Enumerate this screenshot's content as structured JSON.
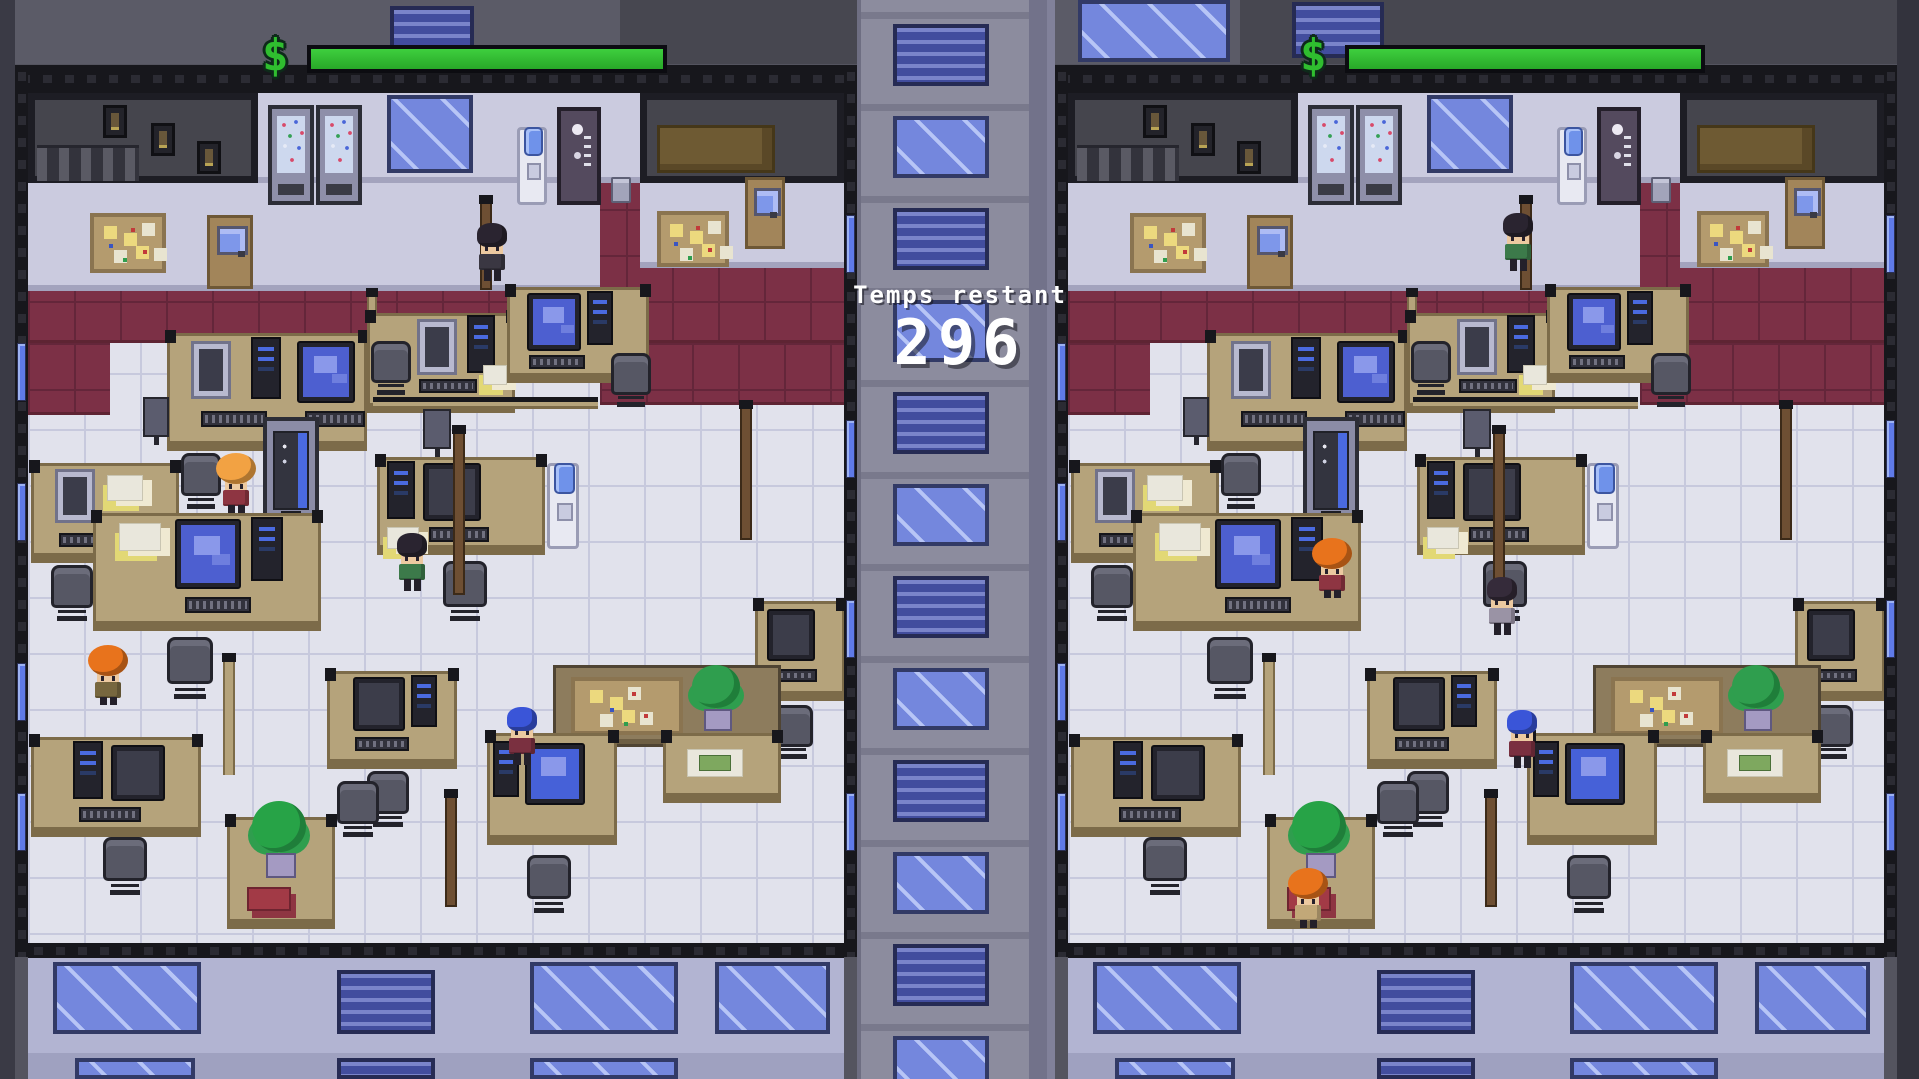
{
  "hud": {
    "symbol": "$",
    "bar_color_top": "#3ecf3e",
    "bar_color_bottom": "#28a828",
    "bars": [
      {
        "side": "left",
        "fill": 1.0
      },
      {
        "side": "right",
        "fill": 1.0
      }
    ]
  },
  "timer": {
    "label": "Temps restant",
    "value": "296"
  },
  "scene": {
    "names": {
      "tile": "tile-floor",
      "carpet": "carpet-floor",
      "darkroom": "dark-room",
      "lavwall": "wall",
      "shelf": "storage-shelf",
      "stairs": "stairs",
      "frame": "picture-frame",
      "winbig": "window",
      "winblinds": "blinds-window",
      "winstrip": "wall-window",
      "vendflower": "flower-vending-machine",
      "venddrink": "vending-machine",
      "coffee": "coffee-machine",
      "cooler": "water-cooler",
      "trash": "trash-bin",
      "board": "cork-board",
      "door": "door",
      "desk": "desk",
      "partition": "cubicle-partition",
      "railh": "cubicle-rail",
      "railv": "cubicle-rail",
      "pole": "cubicle-post",
      "crt": "computer-crt",
      "monitor": "computer-monitor",
      "monitord": "computer-monitor",
      "monitorB": "computer-monitor",
      "tower": "computer-tower",
      "keyboard": "keyboard",
      "chair": "office-chair",
      "camera": "desk-monitor",
      "plant": "potted-plant",
      "palm": "potted-palm",
      "money": "desk-papers",
      "papers": "desk-papers",
      "redbook": "red-binder",
      "extwall": "exterior-wall",
      "extwall2": "exterior-wall",
      "girderh": "steel-beam",
      "girderv": "steel-beam",
      "bgrect": "background-wall"
    },
    "backdrop": [
      {
        "t": "bgrect",
        "x": 0,
        "y": 0,
        "w": 860,
        "h": 64,
        "c": "#5b5b67"
      },
      {
        "t": "bgrect",
        "x": 620,
        "y": 0,
        "w": 240,
        "h": 64,
        "c": "#474750"
      },
      {
        "t": "winblinds",
        "x": 390,
        "y": 6,
        "w": 84,
        "h": 52
      },
      {
        "t": "bgrect",
        "x": 1055,
        "y": 0,
        "w": 842,
        "h": 64,
        "c": "#5b5b67"
      },
      {
        "t": "winbig",
        "x": 1078,
        "y": 0,
        "w": 152,
        "h": 62
      },
      {
        "t": "bgrect",
        "x": 1240,
        "y": 0,
        "w": 657,
        "h": 64,
        "c": "#474750"
      },
      {
        "t": "winblinds",
        "x": 1292,
        "y": 2,
        "w": 92,
        "h": 56
      },
      {
        "t": "bgrect",
        "x": 0,
        "y": 0,
        "w": 15,
        "h": 1079,
        "c": "#3a3a45"
      },
      {
        "t": "bgrect",
        "x": 1897,
        "y": 0,
        "w": 22,
        "h": 1079,
        "c": "#33333d"
      }
    ],
    "divider": {
      "x": 857,
      "y": 0,
      "w": 198,
      "h": 1079,
      "base": "#8c8c9e",
      "ledge": "#79798c",
      "seams": [
        {
          "x": 0,
          "w": 4,
          "c": "#6e6e82"
        },
        {
          "x": 172,
          "w": 18,
          "c": "#72728a"
        },
        {
          "x": 190,
          "w": 8,
          "c": "#81819a"
        }
      ],
      "windows": {
        "x": 36,
        "w": 96,
        "h": 62,
        "start": 24,
        "step": 92,
        "count": 12
      }
    },
    "panels": [
      {
        "id": "left",
        "name": "office-left",
        "x": 15,
        "y": 65
      },
      {
        "id": "right",
        "name": "office-right",
        "x": 1055,
        "y": 65
      }
    ],
    "furniture": [
      {
        "t": "tile",
        "x": 13,
        "y": 28,
        "w": 816,
        "h": 850
      },
      {
        "t": "carpet",
        "x": 13,
        "y": 98,
        "w": 816,
        "h": 180
      },
      {
        "t": "carpet",
        "x": 13,
        "y": 278,
        "w": 82,
        "h": 72
      },
      {
        "t": "carpet",
        "x": 585,
        "y": 278,
        "w": 244,
        "h": 62
      },
      {
        "t": "darkroom",
        "x": 13,
        "y": 28,
        "w": 230,
        "h": 90
      },
      {
        "t": "frame",
        "x": 88,
        "y": 40,
        "w": 24,
        "h": 33
      },
      {
        "t": "frame",
        "x": 136,
        "y": 58,
        "w": 24,
        "h": 33
      },
      {
        "t": "frame",
        "x": 182,
        "y": 76,
        "w": 24,
        "h": 33
      },
      {
        "t": "stairs",
        "x": 22,
        "y": 80,
        "w": 102,
        "h": 36
      },
      {
        "t": "lavwall",
        "x": 243,
        "y": 28,
        "w": 382,
        "h": 90
      },
      {
        "t": "darkroom",
        "x": 625,
        "y": 28,
        "w": 204,
        "h": 90
      },
      {
        "t": "shelf",
        "x": 642,
        "y": 60,
        "w": 118,
        "h": 48
      },
      {
        "t": "lavwall",
        "x": 13,
        "y": 118,
        "w": 572,
        "h": 108
      },
      {
        "t": "lavwall",
        "x": 625,
        "y": 118,
        "w": 204,
        "h": 85
      },
      {
        "t": "vendflower",
        "x": 253,
        "y": 40,
        "w": 46,
        "h": 100,
        "i": 1
      },
      {
        "t": "vendflower",
        "x": 301,
        "y": 40,
        "w": 46,
        "h": 100,
        "i": 1
      },
      {
        "t": "winbig",
        "x": 372,
        "y": 30,
        "w": 86,
        "h": 78
      },
      {
        "t": "cooler",
        "x": 502,
        "y": 62,
        "w": 30,
        "h": 78,
        "i": 1
      },
      {
        "t": "coffee",
        "x": 542,
        "y": 42,
        "w": 44,
        "h": 98,
        "i": 1
      },
      {
        "t": "trash",
        "x": 596,
        "y": 112,
        "w": 20,
        "h": 26
      },
      {
        "t": "board",
        "x": 75,
        "y": 148,
        "w": 76,
        "h": 60
      },
      {
        "t": "door",
        "x": 192,
        "y": 150,
        "w": 46,
        "h": 74,
        "i": 1
      },
      {
        "t": "board",
        "x": 642,
        "y": 146,
        "w": 72,
        "h": 56
      },
      {
        "t": "door",
        "x": 730,
        "y": 112,
        "w": 40,
        "h": 72,
        "i": 1
      },
      {
        "t": "pole",
        "x": 465,
        "y": 130,
        "w": 12,
        "h": 95
      },
      {
        "t": "railv",
        "x": 352,
        "y": 225,
        "w": 10,
        "h": 120
      },
      {
        "t": "desk",
        "x": 152,
        "y": 268,
        "w": 200,
        "h": 118
      },
      {
        "t": "crt",
        "x": 176,
        "y": 276,
        "w": 40,
        "h": 58
      },
      {
        "t": "tower",
        "x": 236,
        "y": 272,
        "w": 30,
        "h": 62
      },
      {
        "t": "monitor",
        "x": 282,
        "y": 276,
        "w": 58,
        "h": 62
      },
      {
        "t": "keyboard",
        "x": 186,
        "y": 346,
        "w": 66,
        "h": 16
      },
      {
        "t": "keyboard",
        "x": 290,
        "y": 346,
        "w": 60,
        "h": 16
      },
      {
        "t": "chair",
        "x": 166,
        "y": 388,
        "w": 40,
        "h": 58
      },
      {
        "t": "camera",
        "x": 128,
        "y": 332,
        "w": 26,
        "h": 40
      },
      {
        "t": "desk",
        "x": 352,
        "y": 248,
        "w": 148,
        "h": 100
      },
      {
        "t": "crt",
        "x": 402,
        "y": 254,
        "w": 40,
        "h": 56
      },
      {
        "t": "tower",
        "x": 452,
        "y": 250,
        "w": 28,
        "h": 58
      },
      {
        "t": "keyboard",
        "x": 404,
        "y": 314,
        "w": 58,
        "h": 14
      },
      {
        "t": "papers",
        "x": 468,
        "y": 300,
        "w": 24,
        "h": 20
      },
      {
        "t": "chair",
        "x": 356,
        "y": 276,
        "w": 40,
        "h": 56
      },
      {
        "t": "desk",
        "x": 492,
        "y": 222,
        "w": 142,
        "h": 96
      },
      {
        "t": "monitor",
        "x": 512,
        "y": 228,
        "w": 54,
        "h": 58
      },
      {
        "t": "tower",
        "x": 572,
        "y": 226,
        "w": 26,
        "h": 54
      },
      {
        "t": "keyboard",
        "x": 514,
        "y": 290,
        "w": 56,
        "h": 14
      },
      {
        "t": "chair",
        "x": 596,
        "y": 288,
        "w": 40,
        "h": 56
      },
      {
        "t": "desk",
        "x": 16,
        "y": 398,
        "w": 148,
        "h": 100
      },
      {
        "t": "crt",
        "x": 40,
        "y": 404,
        "w": 40,
        "h": 54
      },
      {
        "t": "papers",
        "x": 92,
        "y": 410,
        "w": 36,
        "h": 26
      },
      {
        "t": "keyboard",
        "x": 44,
        "y": 468,
        "w": 58,
        "h": 14
      },
      {
        "t": "chair",
        "x": 36,
        "y": 500,
        "w": 42,
        "h": 58
      },
      {
        "t": "venddrink",
        "x": 248,
        "y": 352,
        "w": 56,
        "h": 112,
        "i": 1
      },
      {
        "t": "railh",
        "x": 358,
        "y": 332,
        "w": 225,
        "h": 12
      },
      {
        "t": "camera",
        "x": 408,
        "y": 344,
        "w": 28,
        "h": 40
      },
      {
        "t": "desk",
        "x": 362,
        "y": 392,
        "w": 168,
        "h": 98
      },
      {
        "t": "tower",
        "x": 372,
        "y": 396,
        "w": 28,
        "h": 58
      },
      {
        "t": "monitord",
        "x": 408,
        "y": 398,
        "w": 58,
        "h": 58
      },
      {
        "t": "papers",
        "x": 372,
        "y": 462,
        "w": 32,
        "h": 22
      },
      {
        "t": "keyboard",
        "x": 414,
        "y": 462,
        "w": 60,
        "h": 15
      },
      {
        "t": "cooler",
        "x": 532,
        "y": 398,
        "w": 32,
        "h": 86,
        "i": 1
      },
      {
        "t": "chair",
        "x": 428,
        "y": 496,
        "w": 44,
        "h": 62
      },
      {
        "t": "desk",
        "x": 78,
        "y": 448,
        "w": 228,
        "h": 118
      },
      {
        "t": "papers",
        "x": 104,
        "y": 458,
        "w": 42,
        "h": 28
      },
      {
        "t": "monitor",
        "x": 160,
        "y": 454,
        "w": 66,
        "h": 70
      },
      {
        "t": "tower",
        "x": 236,
        "y": 452,
        "w": 32,
        "h": 64
      },
      {
        "t": "keyboard",
        "x": 170,
        "y": 532,
        "w": 66,
        "h": 16
      },
      {
        "t": "chair",
        "x": 152,
        "y": 572,
        "w": 46,
        "h": 64
      },
      {
        "t": "pole",
        "x": 438,
        "y": 360,
        "w": 12,
        "h": 170
      },
      {
        "t": "pole",
        "x": 725,
        "y": 335,
        "w": 12,
        "h": 140
      },
      {
        "t": "desk",
        "x": 740,
        "y": 536,
        "w": 90,
        "h": 100
      },
      {
        "t": "monitord",
        "x": 752,
        "y": 544,
        "w": 48,
        "h": 52
      },
      {
        "t": "keyboard",
        "x": 754,
        "y": 604,
        "w": 48,
        "h": 13
      },
      {
        "t": "chair",
        "x": 756,
        "y": 640,
        "w": 42,
        "h": 56
      },
      {
        "t": "desk",
        "x": 312,
        "y": 606,
        "w": 130,
        "h": 98
      },
      {
        "t": "monitord",
        "x": 338,
        "y": 612,
        "w": 52,
        "h": 54
      },
      {
        "t": "tower",
        "x": 396,
        "y": 610,
        "w": 26,
        "h": 52
      },
      {
        "t": "keyboard",
        "x": 340,
        "y": 672,
        "w": 54,
        "h": 14
      },
      {
        "t": "chair",
        "x": 352,
        "y": 706,
        "w": 42,
        "h": 58
      },
      {
        "t": "partition",
        "x": 538,
        "y": 600,
        "w": 228,
        "h": 82
      },
      {
        "t": "board",
        "x": 556,
        "y": 612,
        "w": 112,
        "h": 58
      },
      {
        "t": "plant",
        "x": 672,
        "y": 600,
        "w": 58,
        "h": 70
      },
      {
        "t": "desk",
        "x": 648,
        "y": 668,
        "w": 118,
        "h": 70
      },
      {
        "t": "money",
        "x": 672,
        "y": 684,
        "w": 56,
        "h": 28
      },
      {
        "t": "desk",
        "x": 16,
        "y": 672,
        "w": 170,
        "h": 100
      },
      {
        "t": "tower",
        "x": 58,
        "y": 676,
        "w": 30,
        "h": 58
      },
      {
        "t": "monitord",
        "x": 96,
        "y": 680,
        "w": 54,
        "h": 56
      },
      {
        "t": "keyboard",
        "x": 64,
        "y": 742,
        "w": 62,
        "h": 15
      },
      {
        "t": "chair",
        "x": 88,
        "y": 772,
        "w": 44,
        "h": 60
      },
      {
        "t": "railv",
        "x": 208,
        "y": 590,
        "w": 12,
        "h": 120
      },
      {
        "t": "desk",
        "x": 212,
        "y": 752,
        "w": 108,
        "h": 112
      },
      {
        "t": "palm",
        "x": 232,
        "y": 736,
        "w": 64,
        "h": 82
      },
      {
        "t": "redbook",
        "x": 232,
        "y": 822,
        "w": 44,
        "h": 24
      },
      {
        "t": "chair",
        "x": 322,
        "y": 716,
        "w": 42,
        "h": 58
      },
      {
        "t": "pole",
        "x": 430,
        "y": 724,
        "w": 12,
        "h": 118
      },
      {
        "t": "desk",
        "x": 472,
        "y": 668,
        "w": 130,
        "h": 112
      },
      {
        "t": "tower",
        "x": 478,
        "y": 676,
        "w": 26,
        "h": 56
      },
      {
        "t": "monitorB",
        "x": 510,
        "y": 678,
        "w": 60,
        "h": 62
      },
      {
        "t": "chair",
        "x": 512,
        "y": 790,
        "w": 44,
        "h": 60
      },
      {
        "t": "extwall",
        "x": 13,
        "y": 893,
        "w": 816,
        "h": 95
      },
      {
        "t": "winbig",
        "x": 38,
        "y": 897,
        "w": 148,
        "h": 72
      },
      {
        "t": "winblinds",
        "x": 322,
        "y": 905,
        "w": 98,
        "h": 64
      },
      {
        "t": "winbig",
        "x": 515,
        "y": 897,
        "w": 148,
        "h": 72
      },
      {
        "t": "winbig",
        "x": 700,
        "y": 897,
        "w": 115,
        "h": 72
      },
      {
        "t": "extwall2",
        "x": 13,
        "y": 988,
        "w": 816,
        "h": 26
      },
      {
        "t": "winbig",
        "x": 60,
        "y": 993,
        "w": 120,
        "h": 21
      },
      {
        "t": "winblinds",
        "x": 322,
        "y": 993,
        "w": 98,
        "h": 21
      },
      {
        "t": "winbig",
        "x": 515,
        "y": 993,
        "w": 148,
        "h": 21
      }
    ],
    "frame": [
      {
        "t": "girderh",
        "x": 0,
        "y": 0,
        "w": 842,
        "h": 28
      },
      {
        "t": "girderv",
        "x": 0,
        "y": 0,
        "w": 13,
        "h": 892
      },
      {
        "t": "girderv",
        "x": 829,
        "y": 0,
        "w": 13,
        "h": 892
      },
      {
        "t": "girderh",
        "x": 13,
        "y": 878,
        "w": 816,
        "h": 15
      },
      {
        "t": "winstrip",
        "x": 2,
        "y": 278,
        "w": 9,
        "h": 58
      },
      {
        "t": "winstrip",
        "x": 2,
        "y": 418,
        "w": 9,
        "h": 58
      },
      {
        "t": "winstrip",
        "x": 2,
        "y": 598,
        "w": 9,
        "h": 58
      },
      {
        "t": "winstrip",
        "x": 2,
        "y": 728,
        "w": 9,
        "h": 58
      },
      {
        "t": "winstrip",
        "x": 831,
        "y": 150,
        "w": 9,
        "h": 58
      },
      {
        "t": "winstrip",
        "x": 831,
        "y": 355,
        "w": 9,
        "h": 58
      },
      {
        "t": "winstrip",
        "x": 831,
        "y": 535,
        "w": 9,
        "h": 58
      },
      {
        "t": "winstrip",
        "x": 831,
        "y": 728,
        "w": 9,
        "h": 58
      }
    ],
    "characters": {
      "left": [
        {
          "id": "dark-suit",
          "x": 462,
          "y": 158,
          "hair": "#2a2430",
          "shirt": "#3a3742",
          "big": false
        },
        {
          "id": "blond",
          "x": 206,
          "y": 388,
          "hair": "#f2a243",
          "shirt": "#8e3542",
          "big": true
        },
        {
          "id": "green-shirt",
          "x": 382,
          "y": 468,
          "hair": "#2a2430",
          "shirt": "#3c7a4a",
          "big": false
        },
        {
          "id": "orange-left",
          "x": 78,
          "y": 580,
          "hair": "#e8731c",
          "shirt": "#77673f",
          "big": true
        },
        {
          "id": "blue-hair",
          "x": 492,
          "y": 642,
          "hair": "#3a55d8",
          "shirt": "#7a3040",
          "big": false
        }
      ],
      "right": [
        {
          "id": "green-shirt",
          "x": 448,
          "y": 148,
          "hair": "#2a2430",
          "shirt": "#3c7a4a",
          "big": false
        },
        {
          "id": "orange-vending",
          "x": 262,
          "y": 473,
          "hair": "#e8731c",
          "shirt": "#8e3542",
          "big": true
        },
        {
          "id": "dark-desk",
          "x": 432,
          "y": 512,
          "hair": "#352b3a",
          "shirt": "#9a93a5",
          "big": false
        },
        {
          "id": "blue-hair",
          "x": 452,
          "y": 645,
          "hair": "#3a55d8",
          "shirt": "#7a3040",
          "big": false
        },
        {
          "id": "orange-plant",
          "x": 238,
          "y": 803,
          "hair": "#e8731c",
          "shirt": "#c2a878",
          "big": true
        }
      ]
    }
  }
}
